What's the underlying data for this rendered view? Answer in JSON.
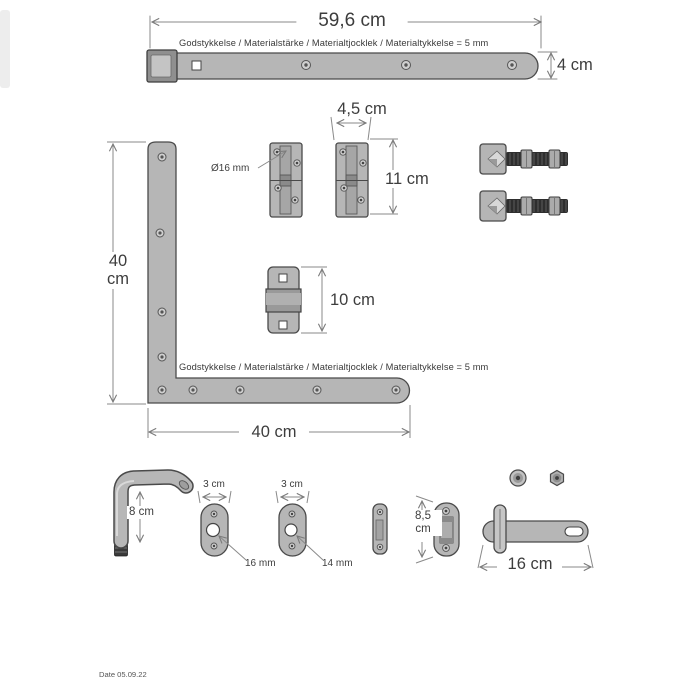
{
  "colors": {
    "metal_fill": "#b6b6b6",
    "metal_dark": "#8f8f8f",
    "outline": "#4a4a4a",
    "shaft_dark": "#2e2e2e",
    "dimension_line": "#8a8a8a",
    "text": "#3c3c3c"
  },
  "notes": {
    "material": "Godstykkelse / Materialstärke / Materialtjocklek / Materialtykkelse = 5 mm"
  },
  "strap_hinge": {
    "length": "59,6 cm",
    "width": "4 cm"
  },
  "hinge_plates": {
    "width": "4,5 cm",
    "height": "11 cm",
    "pin_diameter": "Ø16 mm"
  },
  "corner_bracket": {
    "vertical_length": "40 cm",
    "horizontal_length": "40 cm"
  },
  "middle_keeper": {
    "height": "10 cm"
  },
  "wall_hook": {
    "height": "8 cm"
  },
  "oval_plate_left": {
    "width": "3 cm",
    "hole_diameter": "16 mm"
  },
  "oval_plate_right": {
    "width": "3 cm",
    "hole_diameter": "14 mm"
  },
  "latch_keeper": {
    "height": "8,5 cm"
  },
  "latch_pin": {
    "length": "16 cm"
  },
  "footer": {
    "date": "Date 05.09.22"
  }
}
